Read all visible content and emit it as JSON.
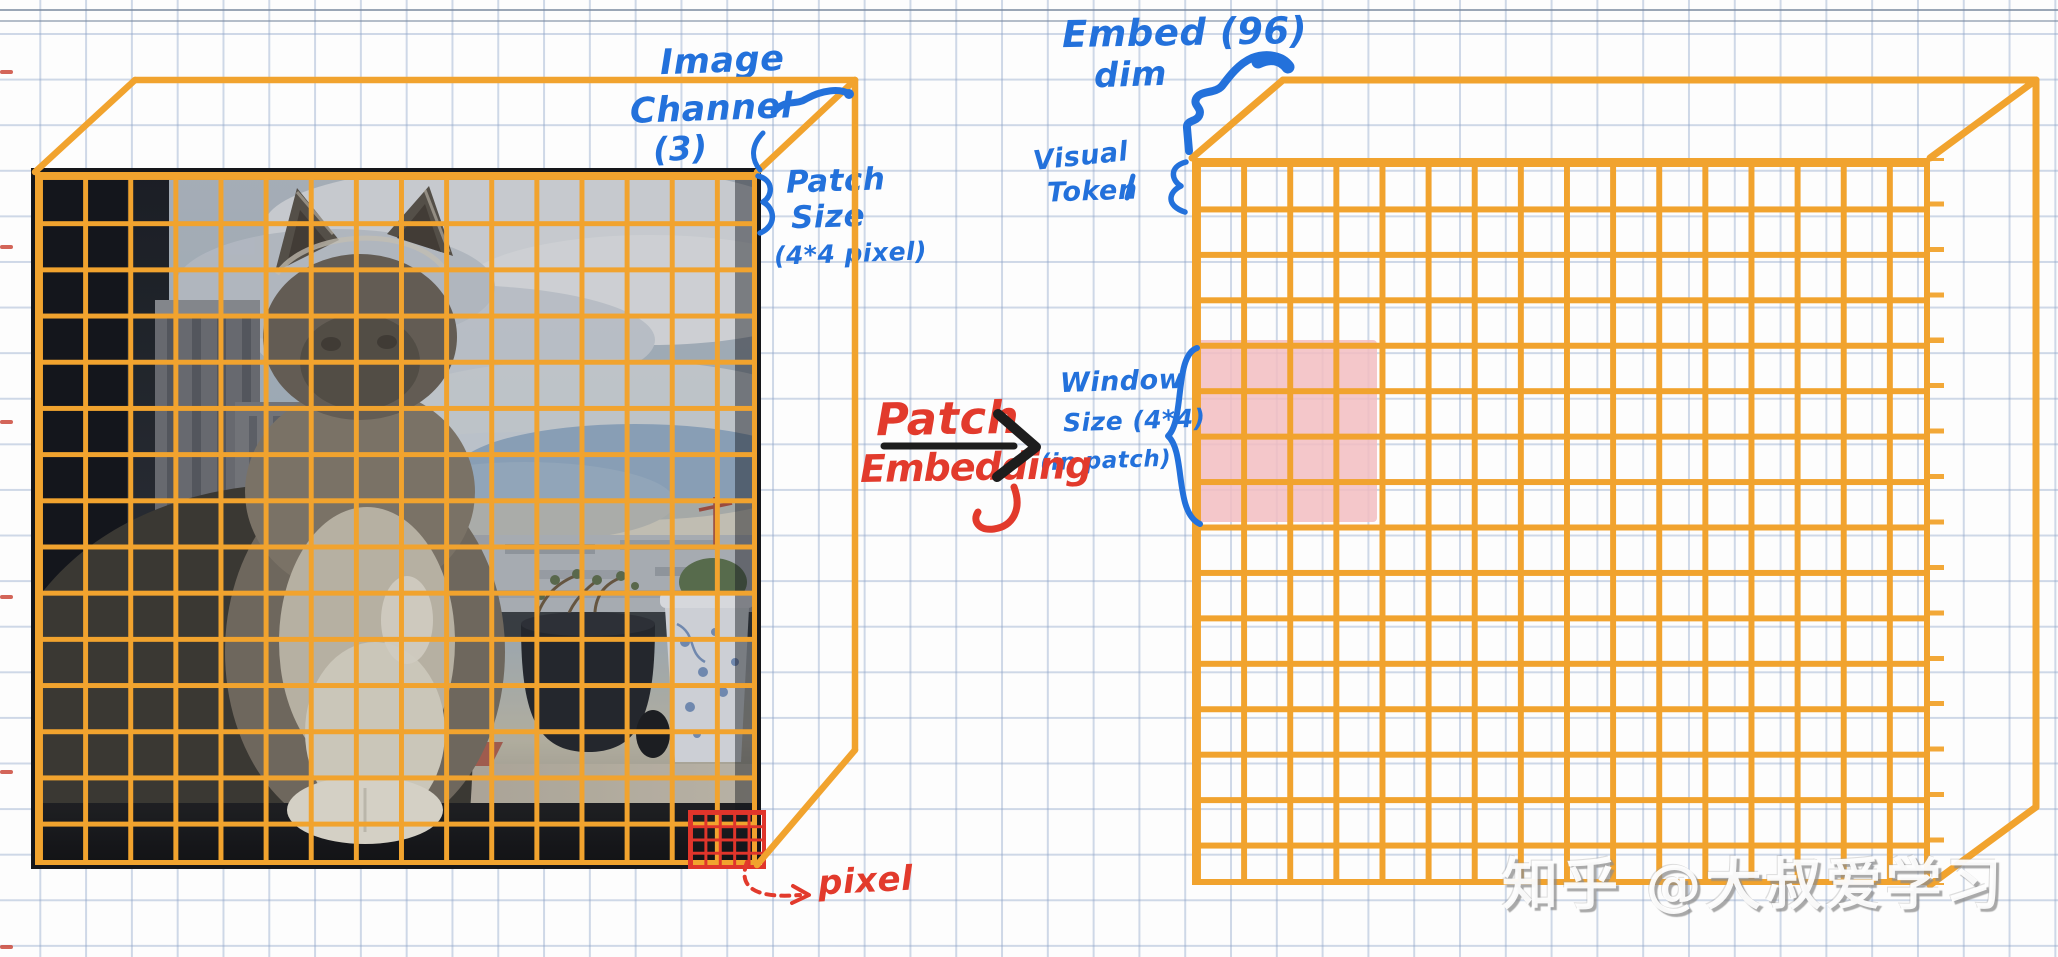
{
  "page": {
    "description": "Hand-drawn diagram on graph paper explaining patch embedding of an image into visual tokens (Swin Transformer style)"
  },
  "ink": {
    "orange": "#F1A32E",
    "blue": "#2371DB",
    "red": "#E23A2C",
    "pink": "#F2BDC1",
    "black": "#1d1d1d"
  },
  "annotations": {
    "image_channel": {
      "lines": [
        "Image",
        "Channel",
        "(3)"
      ]
    },
    "patch_size": {
      "lines": [
        "Patch",
        "Size",
        "(4*4 pixel)"
      ]
    },
    "embed_dim": {
      "lines": [
        "Embed (96)",
        "dim"
      ]
    },
    "visual_token": {
      "lines": [
        "Visual",
        "Token"
      ]
    },
    "window_size": {
      "lines": [
        "Window",
        "Size (4*4)",
        "(in patch)"
      ]
    },
    "patch_embedding": {
      "lines": [
        "Patch",
        "Embedding"
      ]
    },
    "pixel_label": "pixel"
  },
  "left_figure": {
    "title": "input image (cat photo with patch grid)",
    "grid_cols": 16,
    "grid_rows": 15
  },
  "right_figure": {
    "title": "visual token grid",
    "grid_cols": 16,
    "grid_rows": 16,
    "window": {
      "col_start": 0,
      "row_start": 4,
      "cols": 4,
      "rows": 4
    }
  },
  "pixel_grid": {
    "cols": 5,
    "rows": 4
  },
  "watermark": {
    "text": "知乎 @大叔爱学习"
  }
}
